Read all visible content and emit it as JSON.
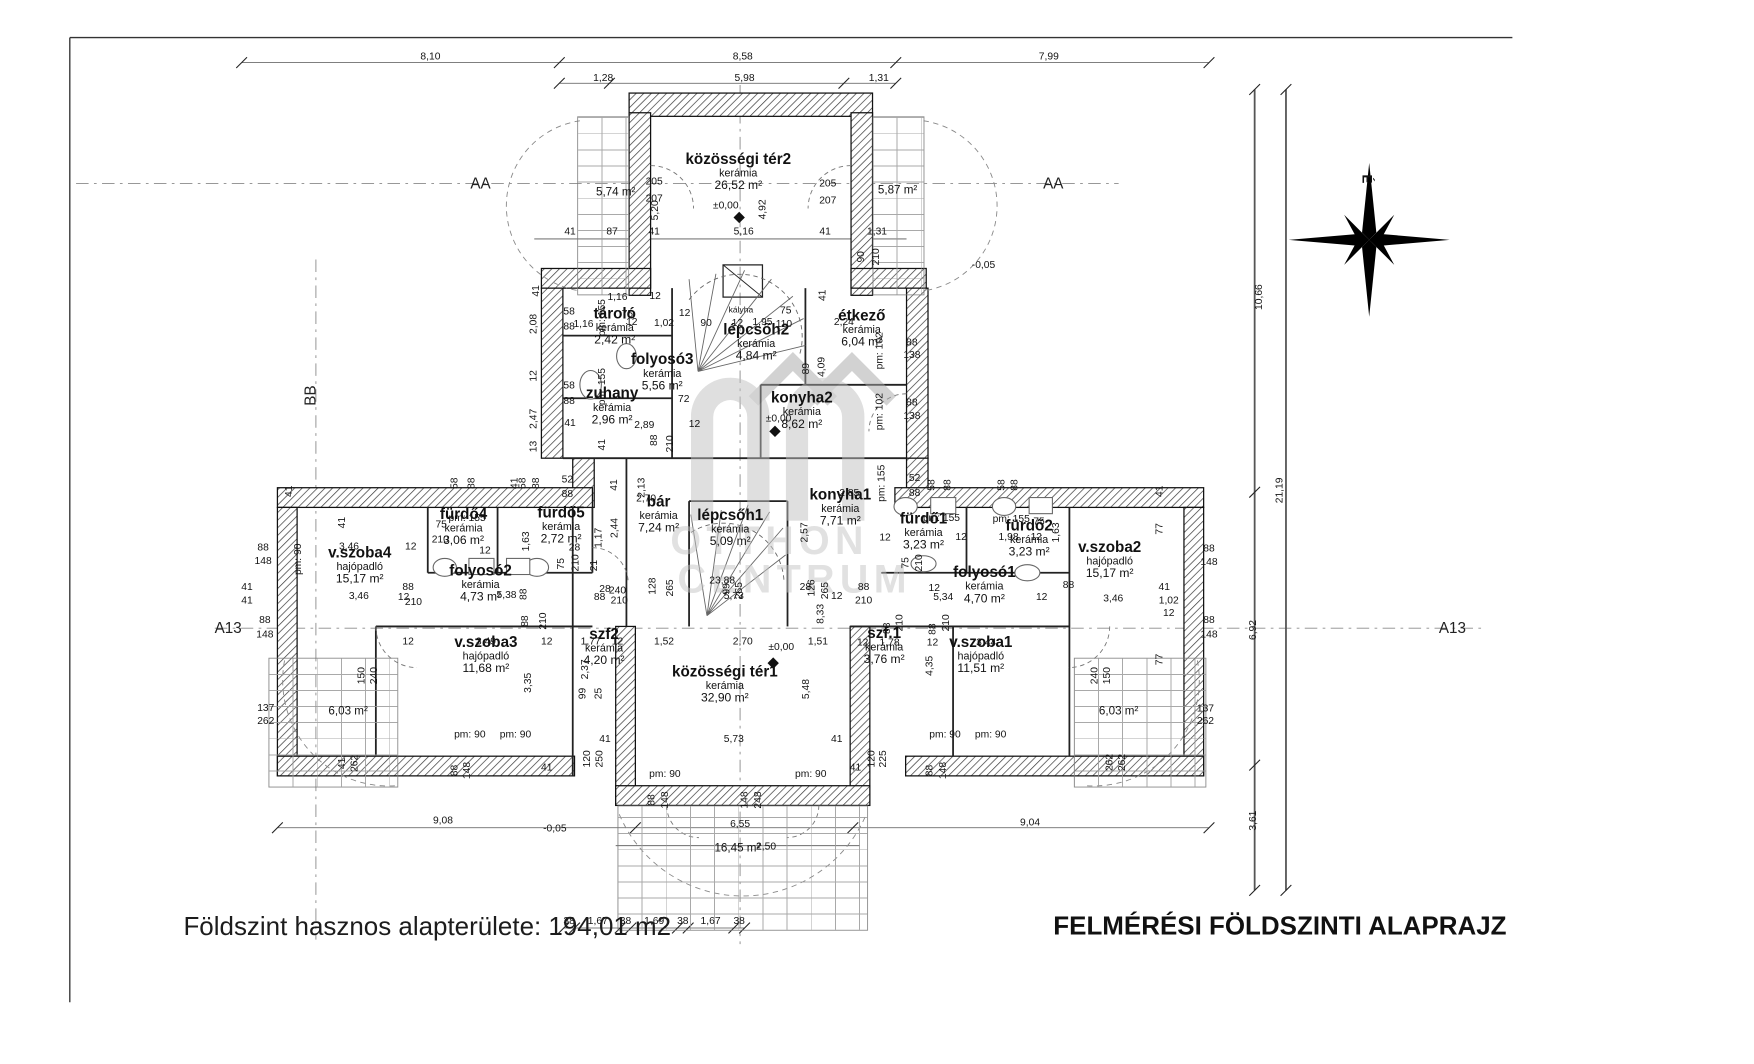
{
  "sheet": {
    "footer_text": "Földszint hasznos alapterülete: 194,01 m2",
    "title_text": "FELMÉRÉSI FÖLDSZINTI ALAPRAJZ",
    "compass_label": "É",
    "watermark": {
      "line1": "OTTHON",
      "line2": "CENTRUM"
    }
  },
  "rooms": [
    {
      "name": "közösségi tér2",
      "mat": "kerámia",
      "area": "26,52 m²",
      "x": 825,
      "y": 190
    },
    {
      "name": "tároló",
      "mat": "kerámia",
      "area": "2,42 m²",
      "x": 687,
      "y": 363
    },
    {
      "name": "folyosó3",
      "mat": "kerámia",
      "area": "5,56 m²",
      "x": 740,
      "y": 414
    },
    {
      "name": "zuhany",
      "mat": "kerámia",
      "area": "2,96 m²",
      "x": 684,
      "y": 452
    },
    {
      "name": "lépcsőh2",
      "mat": "kerámia",
      "area": "4,84 m²",
      "x": 845,
      "y": 381
    },
    {
      "name": "étkező",
      "mat": "kerámia",
      "area": "6,04 m²",
      "x": 963,
      "y": 365
    },
    {
      "name": "konyha2",
      "mat": "kerámia",
      "area": "8,62 m²",
      "x": 896,
      "y": 457
    },
    {
      "name": "konyha1",
      "mat": "kerámia",
      "area": "7,71 m²",
      "x": 939,
      "y": 565
    },
    {
      "name": "bár",
      "mat": "kerámia",
      "area": "7,24 m²",
      "x": 736,
      "y": 573
    },
    {
      "name": "lépcsőh1",
      "mat": "kerámia",
      "area": "5,09 m²",
      "x": 816,
      "y": 588
    },
    {
      "name": "fürdő4",
      "mat": "kerámia",
      "area": "3,06 m²",
      "x": 518,
      "y": 587
    },
    {
      "name": "fürdő5",
      "mat": "kerámia",
      "area": "2,72 m²",
      "x": 627,
      "y": 585
    },
    {
      "name": "folyosó2",
      "mat": "kerámia",
      "area": "4,73 m²",
      "x": 537,
      "y": 650
    },
    {
      "name": "v.szoba4",
      "mat": "hajópadló",
      "area": "15,17 m²",
      "x": 402,
      "y": 630
    },
    {
      "name": "v.szoba3",
      "mat": "hajópadló",
      "area": "11,68 m²",
      "x": 543,
      "y": 730
    },
    {
      "name": "szf2",
      "mat": "kerámia",
      "area": "4,20 m²",
      "x": 675,
      "y": 721
    },
    {
      "name": "közösségi tér1",
      "mat": "kerámia",
      "area": "32,90 m²",
      "x": 810,
      "y": 763
    },
    {
      "name": "szf.1",
      "mat": "kerámia",
      "area": "3,76 m²",
      "x": 988,
      "y": 720
    },
    {
      "name": "v.szoba1",
      "mat": "hajópadló",
      "area": "11,51 m²",
      "x": 1096,
      "y": 730
    },
    {
      "name": "folyosó1",
      "mat": "kerámia",
      "area": "4,70 m²",
      "x": 1100,
      "y": 652
    },
    {
      "name": "fürdő1",
      "mat": "kerámia",
      "area": "3,23 m²",
      "x": 1032,
      "y": 592
    },
    {
      "name": "fürdő2",
      "mat": "kerámia",
      "area": "3,23 m²",
      "x": 1150,
      "y": 600
    },
    {
      "name": "v.szoba2",
      "mat": "hajópadló",
      "area": "15,17 m²",
      "x": 1240,
      "y": 624
    }
  ],
  "labels": [
    {
      "t": "8,10",
      "x": 481,
      "y": 64
    },
    {
      "t": "8,58",
      "x": 830,
      "y": 64
    },
    {
      "t": "7,99",
      "x": 1172,
      "y": 64
    },
    {
      "t": "1,28",
      "x": 674,
      "y": 88
    },
    {
      "t": "5,98",
      "x": 832,
      "y": 88
    },
    {
      "t": "1,31",
      "x": 982,
      "y": 88
    },
    {
      "t": "AA",
      "x": 537,
      "y": 205,
      "c": "mk"
    },
    {
      "t": "AA",
      "x": 1177,
      "y": 205,
      "c": "mk"
    },
    {
      "t": "205",
      "x": 731,
      "y": 204
    },
    {
      "t": "207",
      "x": 731,
      "y": 223
    },
    {
      "t": "5,74 m²",
      "x": 688,
      "y": 214,
      "c": "ar"
    },
    {
      "t": "205",
      "x": 925,
      "y": 206
    },
    {
      "t": "207",
      "x": 925,
      "y": 225
    },
    {
      "t": "5,87 m²",
      "x": 1003,
      "y": 212,
      "c": "ar"
    },
    {
      "t": "5,20",
      "x": 733,
      "y": 235,
      "r": 1
    },
    {
      "t": "4,92",
      "x": 853,
      "y": 234,
      "r": 1
    },
    {
      "t": "±0,00",
      "x": 811,
      "y": 231
    },
    {
      "t": "41",
      "x": 637,
      "y": 260
    },
    {
      "t": "87",
      "x": 684,
      "y": 260
    },
    {
      "t": "41",
      "x": 731,
      "y": 260
    },
    {
      "t": "5,16",
      "x": 831,
      "y": 260
    },
    {
      "t": "41",
      "x": 922,
      "y": 260
    },
    {
      "t": "1,31",
      "x": 980,
      "y": 260
    },
    {
      "t": "90",
      "x": 963,
      "y": 287,
      "r": 1
    },
    {
      "t": "210",
      "x": 980,
      "y": 287,
      "r": 1
    },
    {
      "t": "-0,05",
      "x": 1099,
      "y": 297
    },
    {
      "t": "41",
      "x": 600,
      "y": 325,
      "r": 1
    },
    {
      "t": "2,08",
      "x": 597,
      "y": 362,
      "r": 1
    },
    {
      "t": "12",
      "x": 597,
      "y": 420,
      "r": 1
    },
    {
      "t": "2,47",
      "x": 597,
      "y": 468,
      "r": 1
    },
    {
      "t": "13",
      "x": 597,
      "y": 499,
      "r": 1
    },
    {
      "t": "58",
      "x": 636,
      "y": 349
    },
    {
      "t": "88",
      "x": 636,
      "y": 366
    },
    {
      "t": "1,16",
      "x": 652,
      "y": 363
    },
    {
      "t": "1,16",
      "x": 690,
      "y": 333
    },
    {
      "t": "12",
      "x": 732,
      "y": 332
    },
    {
      "t": "75",
      "x": 701,
      "y": 352
    },
    {
      "t": "12",
      "x": 706,
      "y": 361
    },
    {
      "t": "pm: 155",
      "x": 674,
      "y": 355,
      "r": 1
    },
    {
      "t": "pm: 155",
      "x": 674,
      "y": 432,
      "r": 1
    },
    {
      "t": "1,02",
      "x": 742,
      "y": 362
    },
    {
      "t": "12",
      "x": 765,
      "y": 351
    },
    {
      "t": "90",
      "x": 789,
      "y": 362
    },
    {
      "t": "12",
      "x": 824,
      "y": 362
    },
    {
      "t": "1,95",
      "x": 852,
      "y": 361
    },
    {
      "t": "75",
      "x": 878,
      "y": 348
    },
    {
      "t": "110",
      "x": 876,
      "y": 363
    },
    {
      "t": "kályha",
      "x": 828,
      "y": 347,
      "c": "sm"
    },
    {
      "t": "41",
      "x": 920,
      "y": 330,
      "r": 1
    },
    {
      "t": "2,24",
      "x": 943,
      "y": 361
    },
    {
      "t": "89",
      "x": 902,
      "y": 412,
      "r": 1
    },
    {
      "t": "4,09",
      "x": 919,
      "y": 410,
      "r": 1
    },
    {
      "t": "88",
      "x": 1019,
      "y": 384
    },
    {
      "t": "138",
      "x": 1019,
      "y": 398
    },
    {
      "t": "88",
      "x": 1019,
      "y": 451
    },
    {
      "t": "138",
      "x": 1019,
      "y": 466
    },
    {
      "t": "pm: 102",
      "x": 984,
      "y": 392,
      "r": 1
    },
    {
      "t": "pm: 102",
      "x": 984,
      "y": 460,
      "r": 1
    },
    {
      "t": "58",
      "x": 636,
      "y": 432
    },
    {
      "t": "88",
      "x": 636,
      "y": 449
    },
    {
      "t": "72",
      "x": 764,
      "y": 447
    },
    {
      "t": "2,89",
      "x": 720,
      "y": 476
    },
    {
      "t": "12",
      "x": 776,
      "y": 475
    },
    {
      "t": "41",
      "x": 637,
      "y": 474
    },
    {
      "t": "41",
      "x": 674,
      "y": 497,
      "r": 1
    },
    {
      "t": "88",
      "x": 732,
      "y": 492,
      "r": 1
    },
    {
      "t": "210",
      "x": 750,
      "y": 496,
      "r": 1
    },
    {
      "t": "±0,00",
      "x": 870,
      "y": 469
    },
    {
      "t": "52",
      "x": 634,
      "y": 537
    },
    {
      "t": "88",
      "x": 634,
      "y": 553
    },
    {
      "t": "2,13",
      "x": 718,
      "y": 545,
      "r": 1
    },
    {
      "t": "2,70",
      "x": 722,
      "y": 558
    },
    {
      "t": "41",
      "x": 687,
      "y": 542,
      "r": 1
    },
    {
      "t": "58",
      "x": 509,
      "y": 540,
      "r": 1
    },
    {
      "t": "88",
      "x": 528,
      "y": 540,
      "r": 1
    },
    {
      "t": "41",
      "x": 576,
      "y": 540,
      "r": 1
    },
    {
      "t": "58",
      "x": 585,
      "y": 540,
      "r": 1
    },
    {
      "t": "88",
      "x": 600,
      "y": 540,
      "r": 1
    },
    {
      "t": "2,44",
      "x": 688,
      "y": 590,
      "r": 1
    },
    {
      "t": "1,17",
      "x": 670,
      "y": 601,
      "r": 1
    },
    {
      "t": "28",
      "x": 642,
      "y": 613
    },
    {
      "t": "pm: 155",
      "x": 522,
      "y": 580
    },
    {
      "t": "75",
      "x": 493,
      "y": 587
    },
    {
      "t": "210",
      "x": 492,
      "y": 604
    },
    {
      "t": "12",
      "x": 459,
      "y": 612
    },
    {
      "t": "3,46",
      "x": 390,
      "y": 612
    },
    {
      "t": "41",
      "x": 383,
      "y": 584,
      "r": 1
    },
    {
      "t": "pm: 90",
      "x": 334,
      "y": 625,
      "r": 1
    },
    {
      "t": "12",
      "x": 542,
      "y": 616
    },
    {
      "t": "1,63",
      "x": 589,
      "y": 605,
      "r": 1
    },
    {
      "t": "2,85",
      "x": 949,
      "y": 552
    },
    {
      "t": "2,57",
      "x": 900,
      "y": 595,
      "r": 1
    },
    {
      "t": "pm: 155",
      "x": 986,
      "y": 540,
      "r": 1
    },
    {
      "t": "52",
      "x": 1022,
      "y": 535
    },
    {
      "t": "88",
      "x": 1022,
      "y": 552
    },
    {
      "t": "58",
      "x": 1042,
      "y": 542,
      "r": 1
    },
    {
      "t": "88",
      "x": 1060,
      "y": 542,
      "r": 1
    },
    {
      "t": "58",
      "x": 1120,
      "y": 542,
      "r": 1
    },
    {
      "t": "88",
      "x": 1135,
      "y": 542,
      "r": 1
    },
    {
      "t": "pm: 155",
      "x": 1052,
      "y": 580
    },
    {
      "t": "pm: 155",
      "x": 1130,
      "y": 581
    },
    {
      "t": "75",
      "x": 1161,
      "y": 584
    },
    {
      "t": "12",
      "x": 989,
      "y": 602
    },
    {
      "t": "12",
      "x": 1074,
      "y": 601
    },
    {
      "t": "1,98",
      "x": 1127,
      "y": 601
    },
    {
      "t": "12",
      "x": 1158,
      "y": 601
    },
    {
      "t": "1,63",
      "x": 1181,
      "y": 595,
      "r": 1
    },
    {
      "t": "88",
      "x": 294,
      "y": 613
    },
    {
      "t": "148",
      "x": 294,
      "y": 628
    },
    {
      "t": "41",
      "x": 276,
      "y": 657
    },
    {
      "t": "41",
      "x": 276,
      "y": 672
    },
    {
      "t": "41",
      "x": 324,
      "y": 549,
      "r": 1
    },
    {
      "t": "88",
      "x": 296,
      "y": 694
    },
    {
      "t": "148",
      "x": 296,
      "y": 710
    },
    {
      "t": "88",
      "x": 1351,
      "y": 614
    },
    {
      "t": "148",
      "x": 1351,
      "y": 629
    },
    {
      "t": "41",
      "x": 1301,
      "y": 657
    },
    {
      "t": "1,02",
      "x": 1306,
      "y": 672
    },
    {
      "t": "12",
      "x": 1306,
      "y": 686
    },
    {
      "t": "41",
      "x": 1297,
      "y": 549,
      "r": 1
    },
    {
      "t": "77",
      "x": 1297,
      "y": 591,
      "r": 1
    },
    {
      "t": "77",
      "x": 1297,
      "y": 737,
      "r": 1
    },
    {
      "t": "88",
      "x": 1351,
      "y": 694
    },
    {
      "t": "148",
      "x": 1351,
      "y": 710
    },
    {
      "t": "A13",
      "x": 255,
      "y": 702,
      "c": "mk"
    },
    {
      "t": "A13",
      "x": 1623,
      "y": 702,
      "c": "mk"
    },
    {
      "t": "BB",
      "x": 347,
      "y": 442,
      "r": 1,
      "c": "mk"
    },
    {
      "t": "5,38",
      "x": 566,
      "y": 666
    },
    {
      "t": "88",
      "x": 586,
      "y": 664,
      "r": 1
    },
    {
      "t": "88",
      "x": 456,
      "y": 657
    },
    {
      "t": "12",
      "x": 451,
      "y": 668
    },
    {
      "t": "210",
      "x": 462,
      "y": 674
    },
    {
      "t": "75",
      "x": 628,
      "y": 630,
      "r": 1
    },
    {
      "t": "210",
      "x": 644,
      "y": 629,
      "r": 1
    },
    {
      "t": "21",
      "x": 665,
      "y": 632,
      "r": 1
    },
    {
      "t": "28",
      "x": 676,
      "y": 659
    },
    {
      "t": "240",
      "x": 690,
      "y": 661
    },
    {
      "t": "210",
      "x": 692,
      "y": 672
    },
    {
      "t": "88",
      "x": 670,
      "y": 668
    },
    {
      "t": "88",
      "x": 588,
      "y": 694,
      "r": 1
    },
    {
      "t": "210",
      "x": 608,
      "y": 694,
      "r": 1
    },
    {
      "t": "12",
      "x": 456,
      "y": 718
    },
    {
      "t": "3,49",
      "x": 543,
      "y": 718
    },
    {
      "t": "12",
      "x": 611,
      "y": 718
    },
    {
      "t": "1,77",
      "x": 660,
      "y": 718
    },
    {
      "t": "12",
      "x": 690,
      "y": 718
    },
    {
      "t": "2,37",
      "x": 655,
      "y": 748,
      "r": 1
    },
    {
      "t": "3,35",
      "x": 591,
      "y": 763,
      "r": 1
    },
    {
      "t": "99",
      "x": 652,
      "y": 775,
      "r": 1
    },
    {
      "t": "25",
      "x": 670,
      "y": 775,
      "r": 1
    },
    {
      "t": "128",
      "x": 730,
      "y": 655,
      "r": 1
    },
    {
      "t": "265",
      "x": 750,
      "y": 657,
      "r": 1
    },
    {
      "t": "23,88",
      "x": 807,
      "y": 650
    },
    {
      "t": "99",
      "x": 813,
      "y": 658,
      "r": 1
    },
    {
      "t": "5,73",
      "x": 820,
      "y": 667
    },
    {
      "t": "265",
      "x": 827,
      "y": 660,
      "r": 1
    },
    {
      "t": "28",
      "x": 900,
      "y": 657
    },
    {
      "t": "126",
      "x": 908,
      "y": 657,
      "r": 1
    },
    {
      "t": "265",
      "x": 923,
      "y": 660,
      "r": 1
    },
    {
      "t": "12",
      "x": 935,
      "y": 667
    },
    {
      "t": "88",
      "x": 965,
      "y": 657
    },
    {
      "t": "210",
      "x": 965,
      "y": 672
    },
    {
      "t": "1,52",
      "x": 742,
      "y": 718
    },
    {
      "t": "2,70",
      "x": 830,
      "y": 718
    },
    {
      "t": "±0,00",
      "x": 873,
      "y": 724
    },
    {
      "t": "5,48",
      "x": 902,
      "y": 770,
      "r": 1
    },
    {
      "t": "5,73",
      "x": 820,
      "y": 827
    },
    {
      "t": "41",
      "x": 676,
      "y": 827
    },
    {
      "t": "41",
      "x": 935,
      "y": 827
    },
    {
      "t": "120",
      "x": 657,
      "y": 848,
      "r": 1
    },
    {
      "t": "250",
      "x": 671,
      "y": 848,
      "r": 1
    },
    {
      "t": "120",
      "x": 975,
      "y": 848,
      "r": 1
    },
    {
      "t": "225",
      "x": 988,
      "y": 848,
      "r": 1
    },
    {
      "t": "pm: 90",
      "x": 743,
      "y": 866
    },
    {
      "t": "pm: 90",
      "x": 906,
      "y": 866
    },
    {
      "t": "88",
      "x": 729,
      "y": 894,
      "r": 1
    },
    {
      "t": "148",
      "x": 744,
      "y": 894,
      "r": 1
    },
    {
      "t": "148",
      "x": 833,
      "y": 894,
      "r": 1
    },
    {
      "t": "248",
      "x": 848,
      "y": 894,
      "r": 1
    },
    {
      "t": "6,55",
      "x": 827,
      "y": 922
    },
    {
      "t": "16,45 m²",
      "x": 824,
      "y": 947,
      "c": "ar"
    },
    {
      "t": "2,50",
      "x": 856,
      "y": 947
    },
    {
      "t": "8,33",
      "x": 918,
      "y": 686,
      "r": 1
    },
    {
      "t": "75",
      "x": 1013,
      "y": 629,
      "r": 1
    },
    {
      "t": "210",
      "x": 1028,
      "y": 629,
      "r": 1
    },
    {
      "t": "88",
      "x": 992,
      "y": 702,
      "r": 1
    },
    {
      "t": "210",
      "x": 1006,
      "y": 696,
      "r": 1
    },
    {
      "t": "88",
      "x": 1043,
      "y": 703,
      "r": 1
    },
    {
      "t": "210",
      "x": 1058,
      "y": 696,
      "r": 1
    },
    {
      "t": "1,51",
      "x": 914,
      "y": 718
    },
    {
      "t": "12",
      "x": 964,
      "y": 719
    },
    {
      "t": "1,78",
      "x": 994,
      "y": 719
    },
    {
      "t": "12",
      "x": 1042,
      "y": 719
    },
    {
      "t": "3,44",
      "x": 1102,
      "y": 719
    },
    {
      "t": "4,35",
      "x": 1040,
      "y": 744,
      "r": 1
    },
    {
      "t": "5,34",
      "x": 1054,
      "y": 668
    },
    {
      "t": "12",
      "x": 1044,
      "y": 658
    },
    {
      "t": "88",
      "x": 1194,
      "y": 655
    },
    {
      "t": "12",
      "x": 1164,
      "y": 668
    },
    {
      "t": "3,46",
      "x": 1244,
      "y": 670
    },
    {
      "t": "3,46",
      "x": 401,
      "y": 667
    },
    {
      "t": "pm: 90",
      "x": 525,
      "y": 822
    },
    {
      "t": "pm: 90",
      "x": 576,
      "y": 822
    },
    {
      "t": "88",
      "x": 509,
      "y": 861,
      "r": 1
    },
    {
      "t": "148",
      "x": 523,
      "y": 861,
      "r": 1
    },
    {
      "t": "41",
      "x": 611,
      "y": 859
    },
    {
      "t": "137",
      "x": 297,
      "y": 792
    },
    {
      "t": "262",
      "x": 297,
      "y": 807
    },
    {
      "t": "6,03 m²",
      "x": 389,
      "y": 794,
      "c": "ar"
    },
    {
      "t": "41",
      "x": 383,
      "y": 853,
      "r": 1
    },
    {
      "t": "262",
      "x": 397,
      "y": 853,
      "r": 1
    },
    {
      "t": "150",
      "x": 405,
      "y": 755,
      "r": 1
    },
    {
      "t": "240",
      "x": 419,
      "y": 755,
      "r": 1
    },
    {
      "t": "pm: 90",
      "x": 1056,
      "y": 822
    },
    {
      "t": "pm: 90",
      "x": 1107,
      "y": 822
    },
    {
      "t": "88",
      "x": 1040,
      "y": 861,
      "r": 1
    },
    {
      "t": "148",
      "x": 1055,
      "y": 861,
      "r": 1
    },
    {
      "t": "41",
      "x": 956,
      "y": 859
    },
    {
      "t": "137",
      "x": 1347,
      "y": 793
    },
    {
      "t": "262",
      "x": 1347,
      "y": 807
    },
    {
      "t": "6,03 m²",
      "x": 1250,
      "y": 794,
      "c": "ar"
    },
    {
      "t": "262",
      "x": 1241,
      "y": 852,
      "r": 1
    },
    {
      "t": "262",
      "x": 1255,
      "y": 852,
      "r": 1
    },
    {
      "t": "240",
      "x": 1224,
      "y": 755,
      "r": 1
    },
    {
      "t": "150",
      "x": 1238,
      "y": 755,
      "r": 1
    },
    {
      "t": "9,08",
      "x": 495,
      "y": 918
    },
    {
      "t": "-0,05",
      "x": 620,
      "y": 927
    },
    {
      "t": "9,04",
      "x": 1151,
      "y": 920
    },
    {
      "t": "38",
      "x": 636,
      "y": 1030
    },
    {
      "t": "1,67",
      "x": 668,
      "y": 1030
    },
    {
      "t": "38",
      "x": 699,
      "y": 1030
    },
    {
      "t": "1,69",
      "x": 731,
      "y": 1030
    },
    {
      "t": "38",
      "x": 763,
      "y": 1030
    },
    {
      "t": "1,67",
      "x": 794,
      "y": 1030
    },
    {
      "t": "38",
      "x": 826,
      "y": 1030
    },
    {
      "t": "10,66",
      "x": 1408,
      "y": 332,
      "r": 1
    },
    {
      "t": "21,19",
      "x": 1431,
      "y": 548,
      "r": 1
    },
    {
      "t": "6,92",
      "x": 1401,
      "y": 704,
      "r": 1
    },
    {
      "t": "3,61",
      "x": 1401,
      "y": 917,
      "r": 1
    }
  ]
}
